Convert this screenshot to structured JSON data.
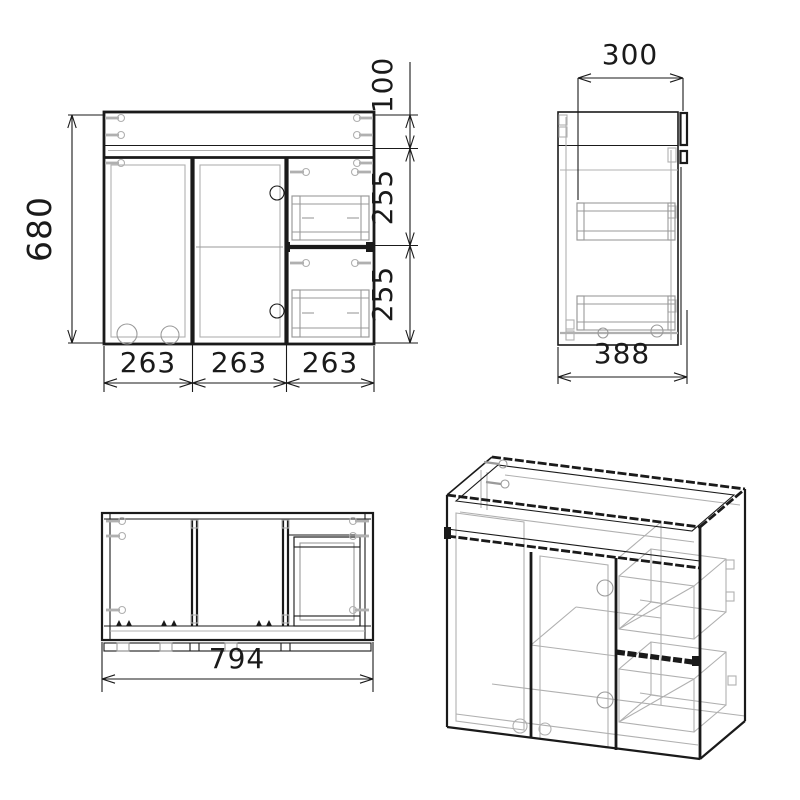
{
  "drawing": {
    "type": "furniture technical drawing",
    "subject": "bathroom vanity cabinet with two doors and two drawers",
    "views": {
      "front": {
        "label": "front view",
        "dims": {
          "overall_height": "680",
          "top_band_height": "100",
          "upper_drawer_height": "255",
          "lower_drawer_height": "255",
          "left_door_width": "263",
          "middle_door_width": "263",
          "drawer_section_width": "263"
        }
      },
      "side": {
        "label": "side view",
        "dims": {
          "top_inset_depth": "300",
          "overall_depth": "388"
        }
      },
      "plan": {
        "label": "top view",
        "dims": {
          "overall_width": "794"
        }
      },
      "iso": {
        "label": "isometric view"
      }
    },
    "colors": {
      "line": "#1a1a1a",
      "hidden_line": "#b0b0b0",
      "background": "#ffffff"
    }
  }
}
